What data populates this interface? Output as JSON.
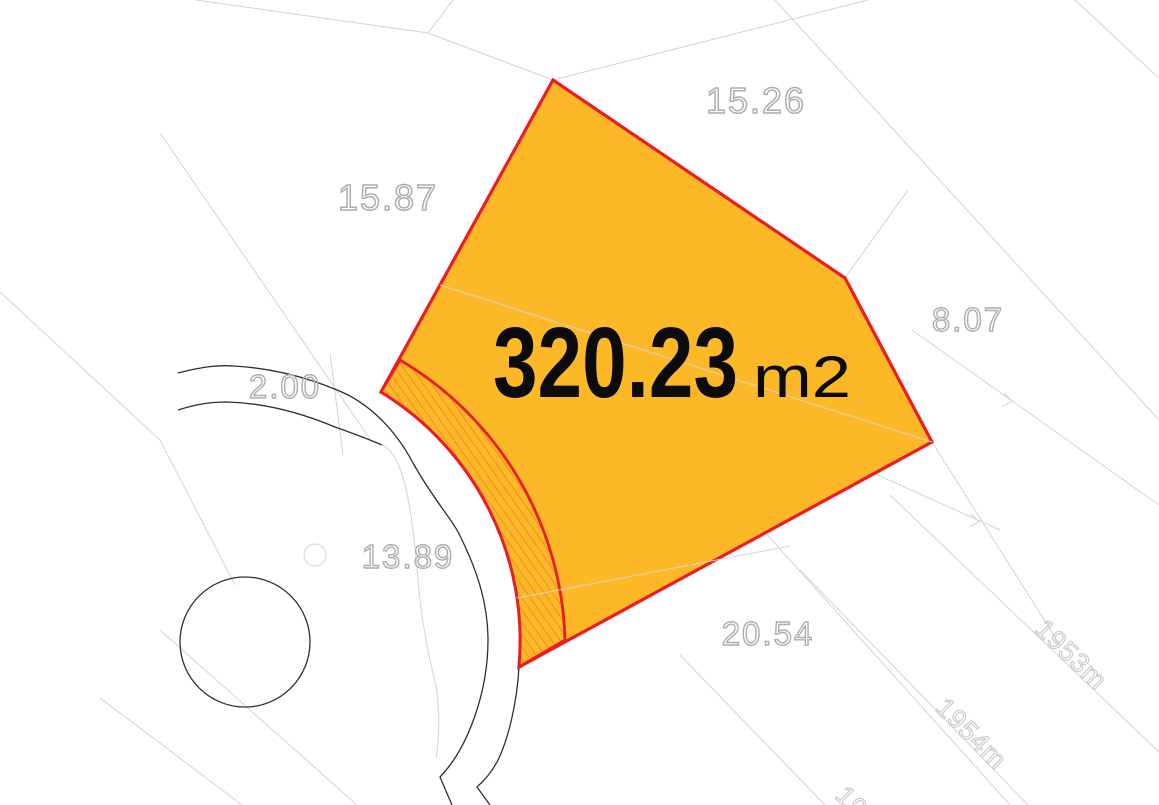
{
  "map": {
    "parcel": {
      "area_value": "320.23",
      "area_unit": "m2"
    },
    "dimension_labels": [
      {
        "id": "top-edge",
        "text": "15.26"
      },
      {
        "id": "left-edge",
        "text": "15.87"
      },
      {
        "id": "right-edge",
        "text": "8.07"
      },
      {
        "id": "road-width",
        "text": "2.00"
      },
      {
        "id": "road-arc",
        "text": "13.89"
      },
      {
        "id": "bottom-edge",
        "text": "20.54"
      }
    ],
    "contour_labels": [
      {
        "id": "contour-1953",
        "text": "1953m"
      },
      {
        "id": "contour-1954",
        "text": "1954m"
      },
      {
        "id": "contour-partial",
        "text": "195"
      }
    ],
    "colors": {
      "parcel_fill": "#FCB826",
      "boundary_red": "#ED1C24",
      "hatch_orange": "#EE8D2B",
      "dim_text_gray": "#ADADAD",
      "background_line_gray": "#D4D4D4",
      "road_line_black": "#2F2F2F",
      "area_text_black": "#0B0B0B"
    }
  }
}
